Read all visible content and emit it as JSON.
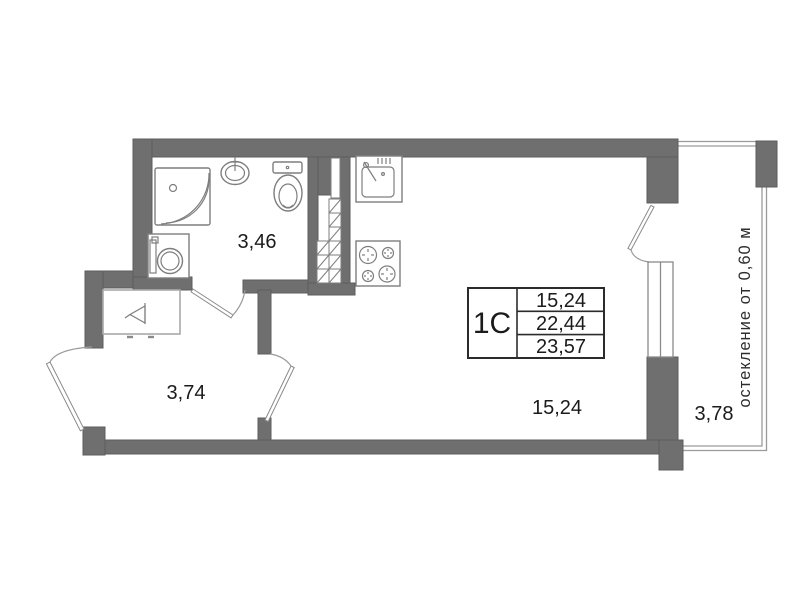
{
  "unit_card": {
    "unit": "1С",
    "area_values": [
      "15,24",
      "22,44",
      "23,57"
    ]
  },
  "room_labels": {
    "bathroom": "3,46",
    "hallway": "3,74",
    "living_room": "15,24",
    "balcony": "3,78"
  },
  "balcony_note": "остекление от 0,60 м",
  "colors": {
    "wall": "#6f6f6f",
    "thin_line": "#9a9a9a",
    "text": "#1b1b1b"
  }
}
